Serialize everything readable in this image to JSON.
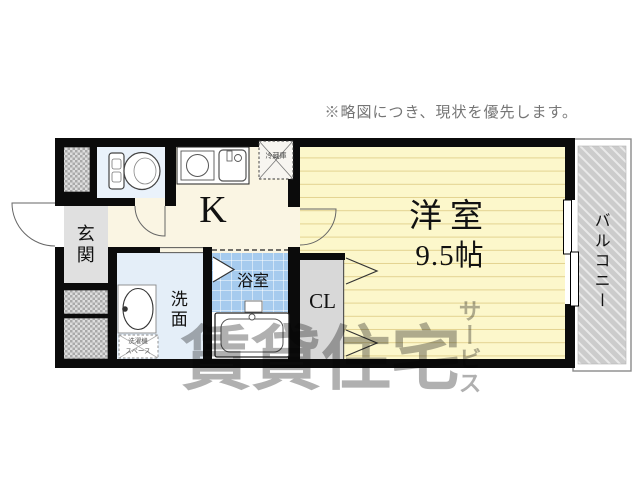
{
  "note": "※略図につき、現状を優先します。",
  "watermark": {
    "main": "賃貸住宅",
    "sub": "サービス"
  },
  "rooms": {
    "entrance": "玄関",
    "kitchen": "K",
    "western_room_name": "洋室",
    "western_room_size": "9.5帖",
    "closet": "CL",
    "washroom": "洗面",
    "bathroom": "浴室",
    "balcony": "バルコニー"
  },
  "fixtures": {
    "refrigerator": "冷蔵庫",
    "washer_line1": "洗濯機",
    "washer_line2": "スペース"
  },
  "colors": {
    "wall": "#0b0b0b",
    "kitchen_floor": "#faf5e3",
    "western_room_floor": "#fcf7cb",
    "western_room_line": "#e3d391",
    "bath_tile": "#a6cbee",
    "entrance_floor": "#e0e0e0",
    "washroom_floor": "#e4eef8",
    "toilet_floor": "#eaf2fb",
    "closet_floor": "#d8d8d8",
    "balcony_hatch": "#cccccc",
    "note_text": "#757575",
    "watermark": "#b0b0b0"
  }
}
